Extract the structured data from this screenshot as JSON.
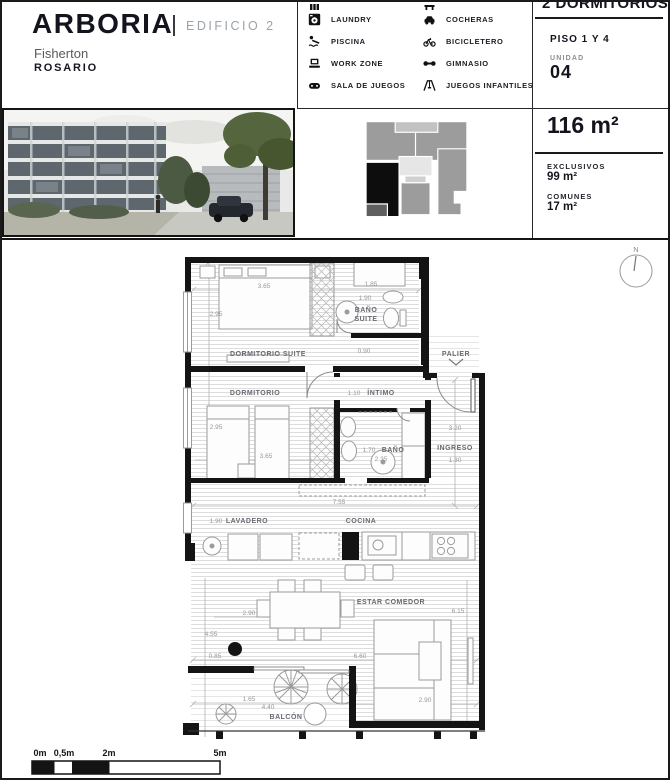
{
  "colors": {
    "ink": "#14141e",
    "muted": "#9aa2ab",
    "wall": "#141414",
    "dim_text": "#97979c"
  },
  "header": {
    "brand": "ARBORIA",
    "edition": "EDIFICIO 2",
    "area": "Fisherton",
    "city": "ROSARIO"
  },
  "amenities": {
    "left": [
      {
        "icon": "cropped-icon",
        "label": ""
      },
      {
        "icon": "laundry-icon",
        "label": "LAUNDRY"
      },
      {
        "icon": "pool-icon",
        "label": "PISCINA"
      },
      {
        "icon": "workzone-icon",
        "label": "WORK ZONE"
      },
      {
        "icon": "gameroom-icon",
        "label": "SALA DE JUEGOS"
      }
    ],
    "right": [
      {
        "icon": "cropped-icon",
        "label": ""
      },
      {
        "icon": "parking-icon",
        "label": "COCHERAS"
      },
      {
        "icon": "bike-icon",
        "label": "BICICLETERO"
      },
      {
        "icon": "gym-icon",
        "label": "GIMNASIO"
      },
      {
        "icon": "playground-icon",
        "label": "JUEGOS INFANTILES"
      }
    ]
  },
  "unit_panel": {
    "title": "2 DORMITORIOS",
    "floor": "PISO 1 Y 4",
    "unit_label": "UNIDAD",
    "unit_number": "04"
  },
  "area_panel": {
    "total": "116 m²",
    "exclusive_label": "EXCLUSIVOS",
    "exclusive_value": "99 m²",
    "common_label": "COMUNES",
    "common_value": "17 m²"
  },
  "plan": {
    "compass": "N",
    "rooms": {
      "dormitorio_suite": "DORMITORIO SUITE",
      "bano_suite_1": "BAÑO",
      "bano_suite_2": "SUITE",
      "dormitorio": "DORMITORIO",
      "intimo": "ÍNTIMO",
      "bano": "BAÑO",
      "palier": "PALIER",
      "ingreso": "INGRESO",
      "lavadero": "LAVADERO",
      "cocina": "COCINA",
      "estar_comedor": "ESTAR COMEDOR",
      "balcon": "BALCÓN"
    },
    "dims": {
      "suite_w": "3.65",
      "suite_h": "2.95",
      "bs_w": "1.85",
      "bs_h": "1.90",
      "bs_d": "0.90",
      "dorm_h": "2.95",
      "dorm_w": "3.65",
      "intimo_w": "1.10",
      "bano_w": "1.70",
      "bano_l": "2.35",
      "ingreso_h": "3.20",
      "ingreso_w": "1.30",
      "cocina_w": "7.55",
      "lavadero_w": "1.90",
      "table_w": "2.90",
      "estar_h": "6.15",
      "estar_l": "4.55",
      "estar_o": "0.85",
      "estar_w": "6.60",
      "balcon_h": "1.65",
      "balcon_w": "4.40",
      "sofa_w": "2.90"
    }
  },
  "scalebar": {
    "l0": "0m",
    "l1": "0,5m",
    "l2": "2m",
    "l3": "5m"
  }
}
